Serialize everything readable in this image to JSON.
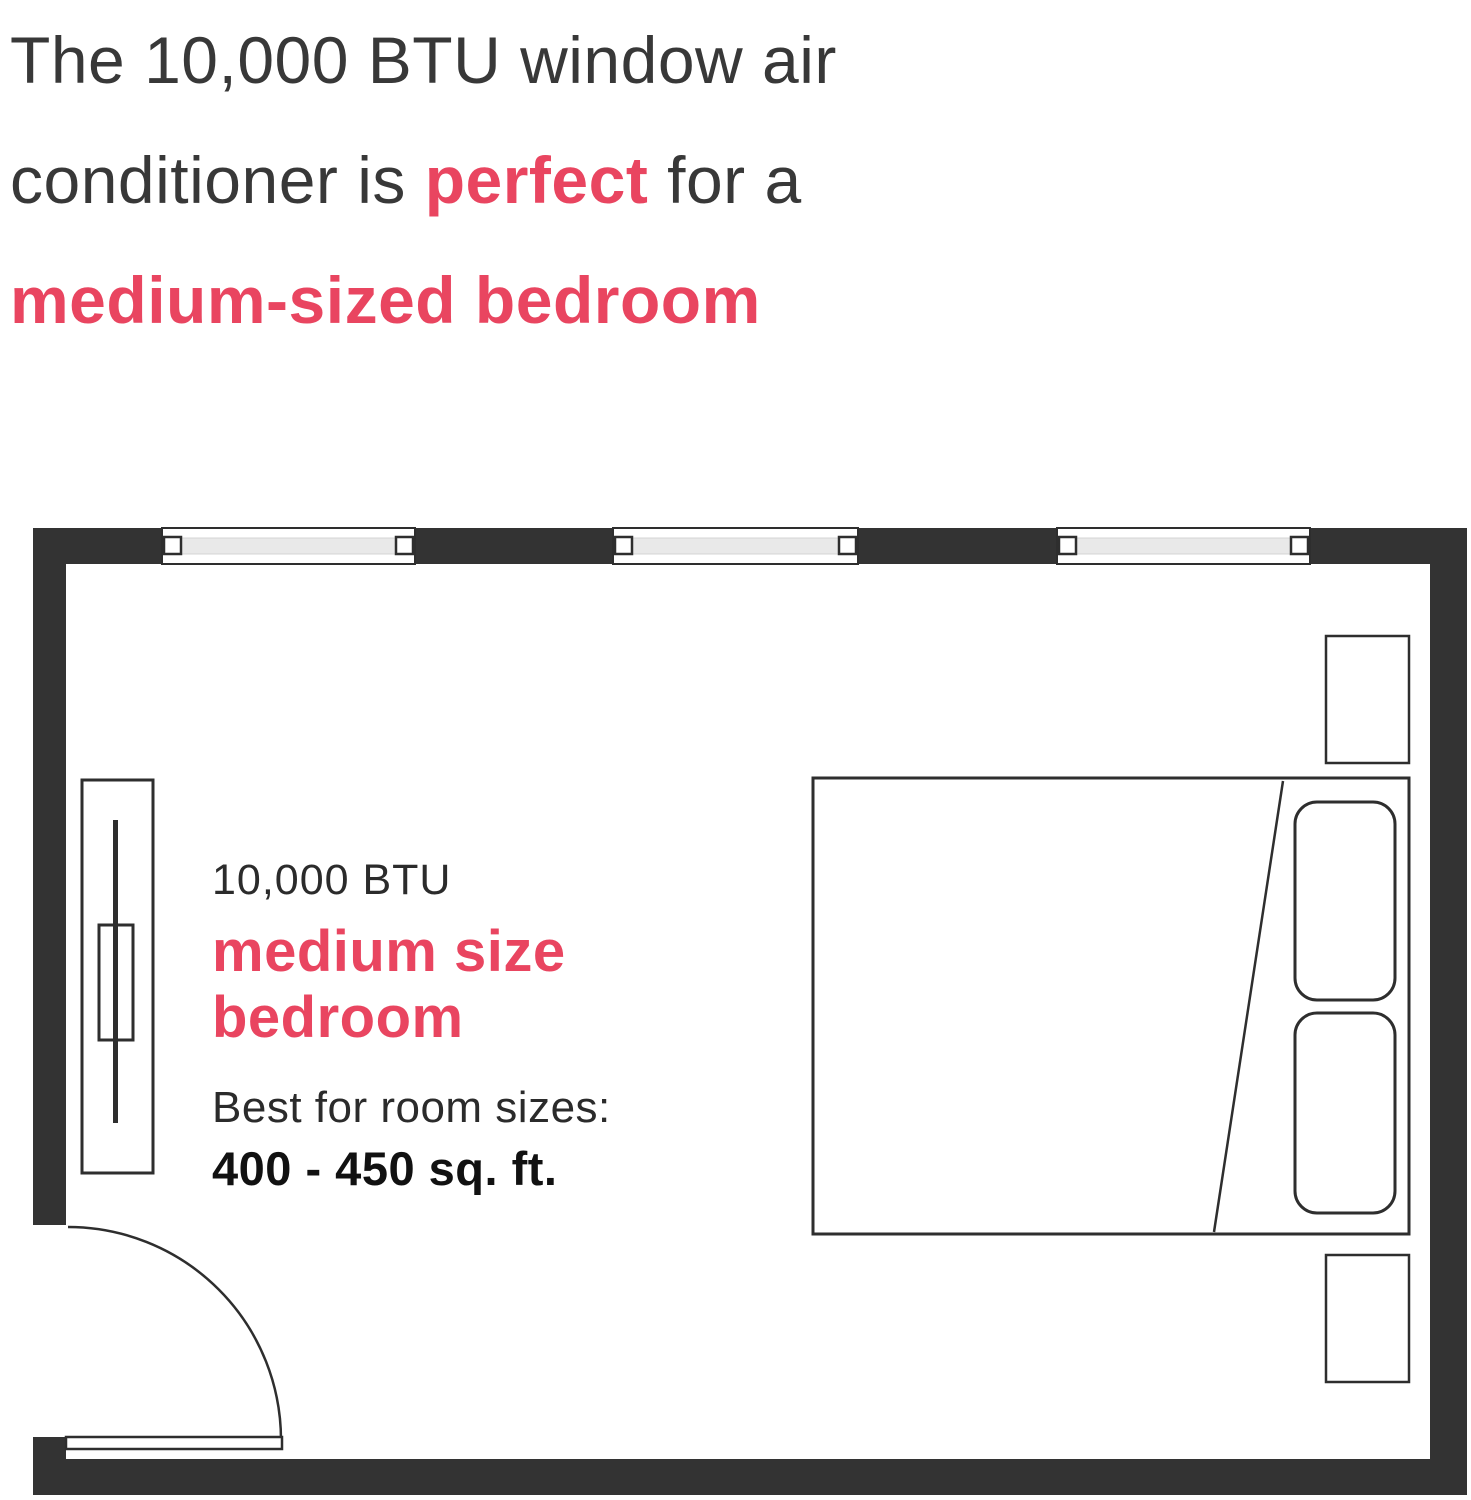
{
  "headline": {
    "line1": "The 10,000 BTU window air",
    "line2_pre": "conditioner is ",
    "line2_accent": "perfect",
    "line2_post": " for a",
    "line3": "medium-sized bedroom"
  },
  "room_label": {
    "btu": "10,000 BTU",
    "size_line1": "medium size",
    "size_line2": "bedroom",
    "best_for": "Best for room sizes:",
    "range": "400 - 450 sq. ft."
  },
  "colors": {
    "accent": "#E94560",
    "wall": "#333333",
    "line": "#2E2E2E",
    "glass": "#E9E9E9",
    "headline_text": "#383838",
    "body_text": "#2B2B2B"
  }
}
